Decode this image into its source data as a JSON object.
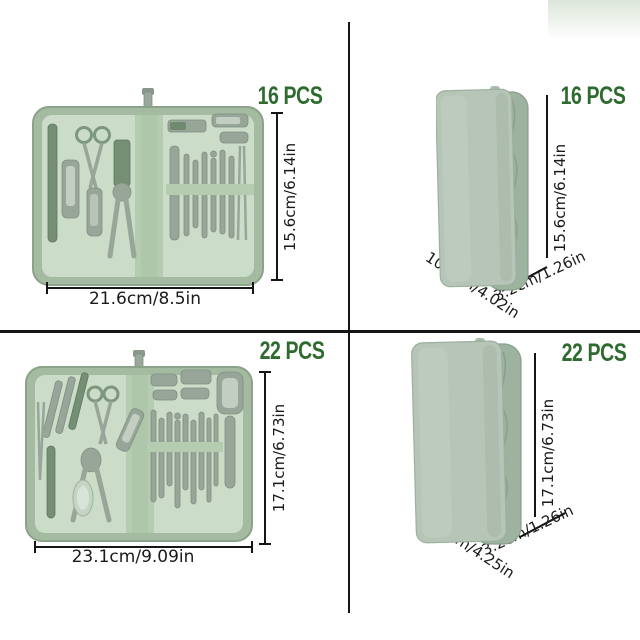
{
  "product_image": {
    "description_visible_text_only": true,
    "quadrants": [
      {
        "id": "open-16",
        "view": "open-case",
        "pcs": "16 PCS",
        "height": "15.6cm/6.14in",
        "width": "21.6cm/8.5in"
      },
      {
        "id": "closed-16",
        "view": "closed-case",
        "pcs": "16 PCS",
        "height": "15.6cm/6.14in",
        "width": "10.2cm/4.02in",
        "depth": "3.2cm/1.26in"
      },
      {
        "id": "open-22",
        "view": "open-case",
        "pcs": "22 PCS",
        "height": "17.1cm/6.73in",
        "width": "23.1cm/9.09in"
      },
      {
        "id": "closed-22",
        "view": "closed-case",
        "pcs": "22 PCS",
        "height": "17.1cm/6.73in",
        "width": "10.8cm/4.25in",
        "depth": "3.2cm/1.26in"
      }
    ],
    "colors": {
      "background": "#ffffff",
      "line_color": "#151515",
      "dim_text": "#1a1a1a",
      "pcs_green": "#2e6b2e",
      "case_outer": "#a4bba1",
      "case_interior": "#cbdcc8",
      "case_strap": "#b6ccb1",
      "tool_metal": "#97a698",
      "closed_front": "#b6c5b7",
      "closed_side": "#9db29f"
    }
  }
}
